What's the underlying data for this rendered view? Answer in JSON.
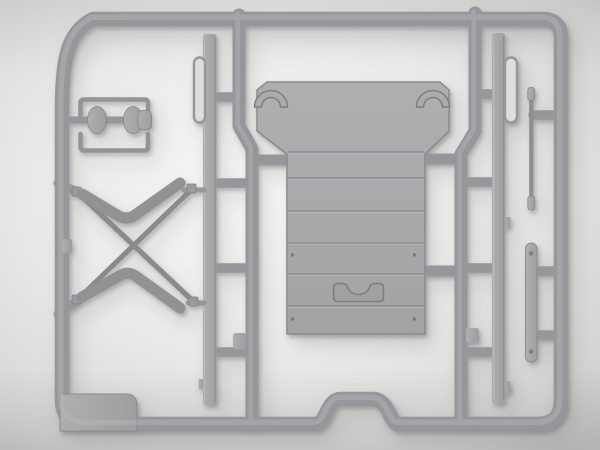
{
  "scene": {
    "subject": "Gray injection-molded plastic model kit sprue (parts tree) with a large flat floor panel, X cross-brace, axle, strips and rod parts, photographed on a neutral studio background",
    "aria_label": "Plastic model kit sprue with gray parts"
  },
  "colors": {
    "background_center": "#f7f7f5",
    "background_mid": "#eaeae8",
    "background_outer": "#d6d6d4",
    "background_edge": "#c4c4c2",
    "sprue_frame": "#96979a",
    "sprue_highlight": "#b6b7b9",
    "part_light": "#aeafb1",
    "part_fill": "#9d9ea0",
    "panel_light": "#aeafb1",
    "panel_fill": "#a2a3a5",
    "panel_line": "#8c8d8f",
    "engraving": "#7d7e80",
    "channel_fill": "#dededc",
    "rivet": "#797a7c",
    "shadow": "rgba(70,70,72,0.35)"
  },
  "parts": {
    "frame": "outer sprue frame",
    "runner_left": "left vertical runner",
    "runner_right": "right vertical runner",
    "panel": "cargo floor panel with wheel-arch details and grab-handle recess",
    "x_brace": "X-shaped cross brace",
    "axle": "axle shaft with joint lobes",
    "bracket_top": "upper channel bracket",
    "bracket_bottom": "lower channel bracket",
    "strip_left": "long left side strip",
    "channel_left": "thin channel strip left",
    "strip_right": "long right side strip",
    "channel_right": "thin channel strip right",
    "rod": "connecting rod with end fittings",
    "strap": "riveted strap",
    "tab": "corner gate tab",
    "gates": "sprue gates"
  }
}
